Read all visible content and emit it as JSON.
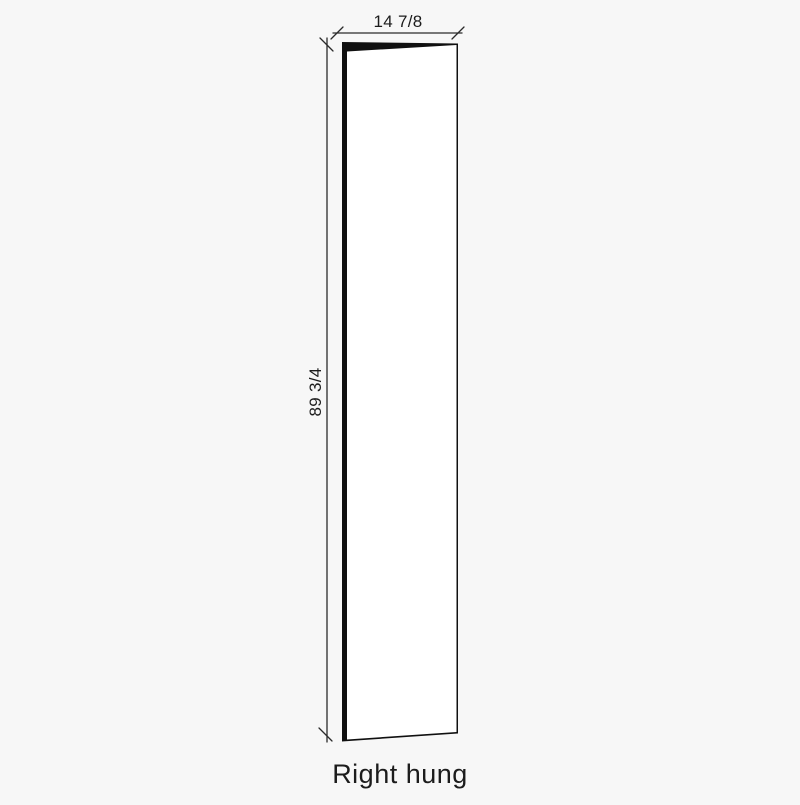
{
  "diagram": {
    "caption": "Right hung",
    "dimensions": {
      "width": "14 7/8",
      "height": "89 3/4"
    },
    "colors": {
      "background": "#f7f7f7",
      "dimension_line": "#2b2b2b",
      "door_edge": "#101010",
      "door_face": "#ffffff",
      "text": "#1c1c1c"
    }
  }
}
